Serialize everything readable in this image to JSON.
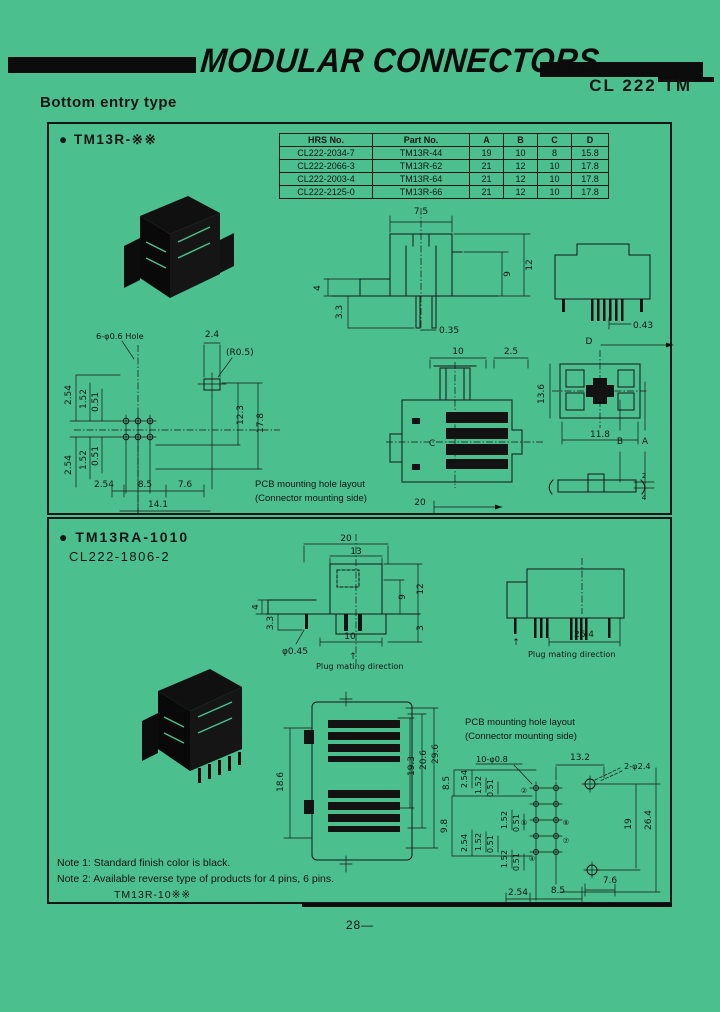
{
  "page": {
    "number": "28—"
  },
  "header": {
    "title": "MODULAR CONNECTORS",
    "product_code": "CL 222 TM",
    "subtitle": "Bottom entry type"
  },
  "panel1": {
    "title": "● TM13R-※※",
    "table": {
      "headers": [
        "HRS No.",
        "Part No.",
        "A",
        "B",
        "C",
        "D"
      ],
      "rows": [
        [
          "CL222-2034-7",
          "TM13R-44",
          "19",
          "10",
          "8",
          "15.8"
        ],
        [
          "CL222-2066-3",
          "TM13R-62",
          "21",
          "12",
          "10",
          "17.8"
        ],
        [
          "CL222-2003-4",
          "TM13R-64",
          "21",
          "12",
          "10",
          "17.8"
        ],
        [
          "CL222-2125-0",
          "TM13R-66",
          "21",
          "12",
          "10",
          "17.8"
        ]
      ]
    },
    "front": {
      "w_75": "7.5",
      "h_9": "9",
      "h_12": "12",
      "l_4": "4",
      "l_33": "3.3",
      "pin_035": "0.35"
    },
    "side": {
      "pin_043": "0.43",
      "label_d": "D"
    },
    "bottom": {
      "w_10": "10",
      "w_25": "2.5",
      "label_c": "C",
      "label_b": "B",
      "label_a": "A",
      "w_20": "20",
      "h_136": "13.6",
      "w_118": "11.8",
      "s_2": "2",
      "s_4": "4"
    },
    "pcb": {
      "hole_note": "6-φ0.6 Hole",
      "w_24": "2.4",
      "r_05": "(R0.5)",
      "p1": "2.54",
      "p2": "1.52",
      "p3": "0.51",
      "q1": "2.54",
      "q2": "1.52",
      "q3": "0.51",
      "h_123": "12.3",
      "h_178": "17.8",
      "b_254": "2.54",
      "b_85": "8.5",
      "b_76": "7.6",
      "b_141": "14.1",
      "caption1": "PCB mounting hole layout",
      "caption2": "(Connector mounting side)"
    }
  },
  "panel2": {
    "title": "● TM13RA-1010",
    "subtitle": "CL222-1806-2",
    "front": {
      "w_20": "20",
      "w_13": "13",
      "l_4": "4",
      "l_33": "3.3",
      "h_9": "9",
      "h_12": "12",
      "w_10": "10",
      "h_3": "3",
      "hole": "φ0.45",
      "arrow": "↑",
      "caption": "Plug mating direction"
    },
    "side": {
      "w_264": "26.4",
      "arrow": "↑",
      "caption": "Plug mating direction"
    },
    "section": {
      "h_186": "18.6",
      "h_193": "19.3",
      "h_206": "20.6",
      "h_296": "29.6"
    },
    "pcb": {
      "caption1": "PCB mounting hole layout",
      "caption2": "(Connector mounting side)",
      "hole_note": "10-φ0.8",
      "w_132": "13.2",
      "hole_note2": "2-φ2.4",
      "l_85": "8.5",
      "l_98": "9.8",
      "g1a": "2.54",
      "g1b": "1.52",
      "g1c": "0.51",
      "g2a": "2.54",
      "g2b": "1.52",
      "g2c": "0.51",
      "g3a": "1.52",
      "g3b": "0.51",
      "g4a": "1.52",
      "g4b": "0.51",
      "r_19": "19",
      "r_264": "26.4",
      "b_254": "2.54",
      "b_85": "8.5",
      "b_76": "7.6",
      "pin_2": "②",
      "pin_4": "④",
      "pin_5": "⑤",
      "pin_7": "⑦",
      "pin_8": "⑧"
    },
    "notes": [
      "Note 1: Standard finish color is black.",
      "Note 2: Available reverse type of products for 4 pins, 6 pins.",
      "TM13R-10※※"
    ]
  }
}
